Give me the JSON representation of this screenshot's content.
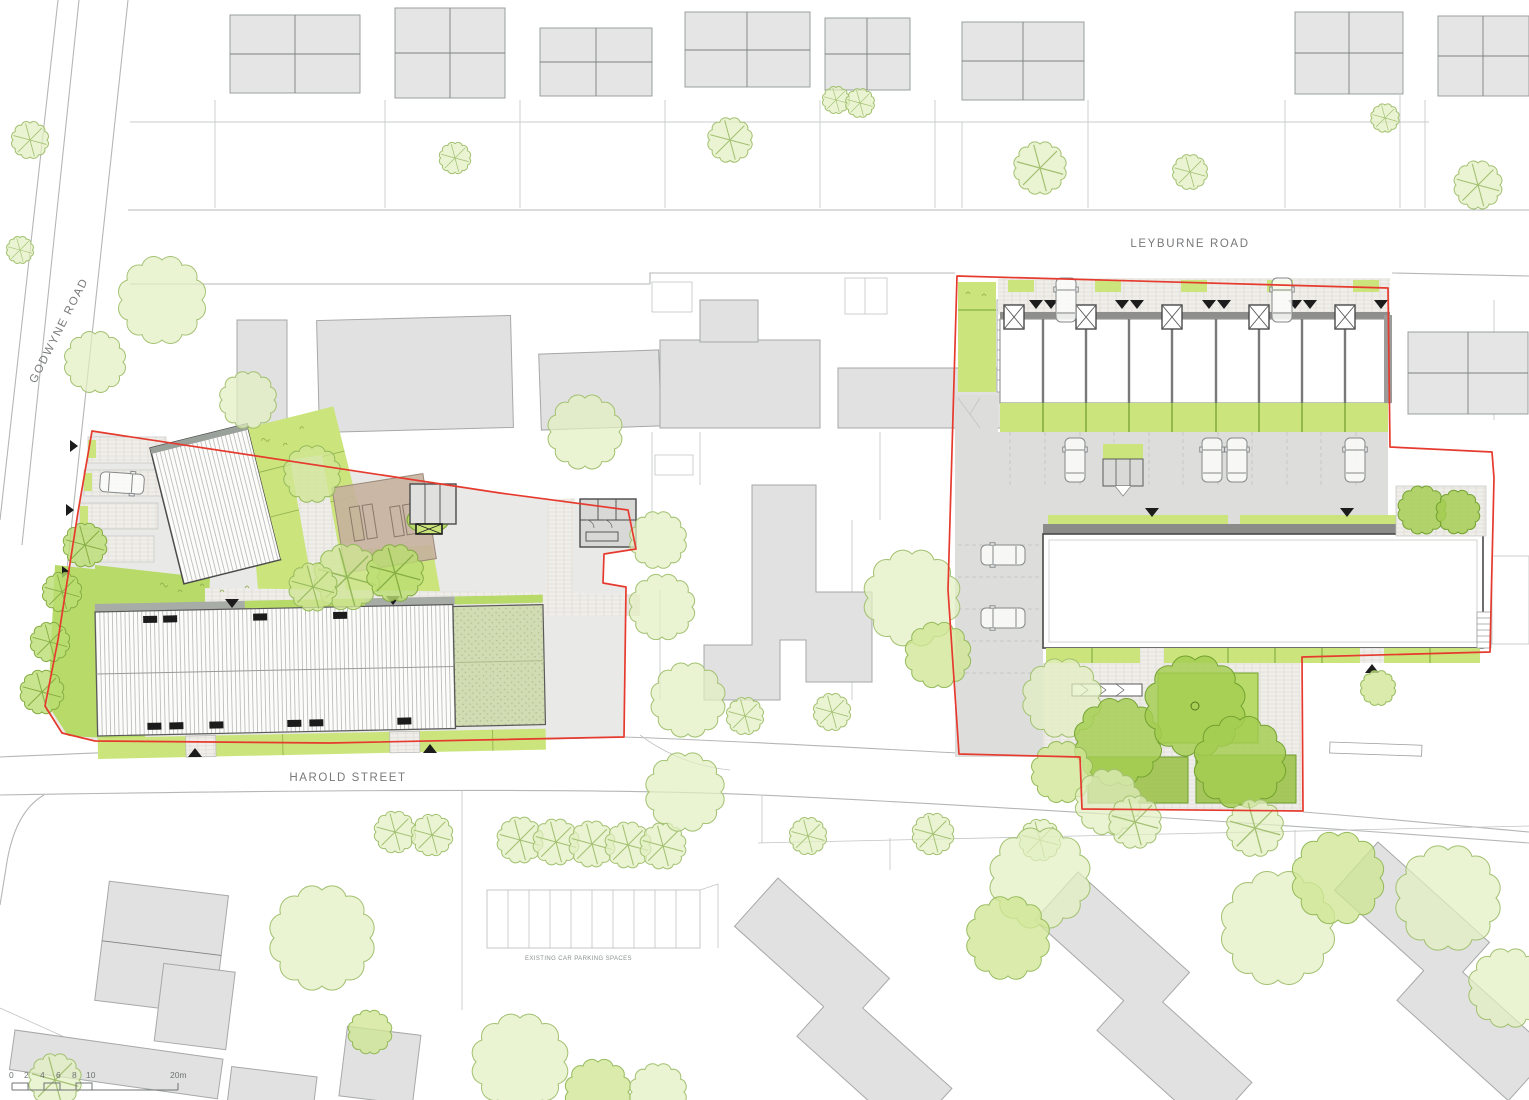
{
  "drawing": {
    "type": "architectural-site-plan",
    "labels": {
      "road_top": "LEYBURNE ROAD",
      "road_left": "GODWYNE ROAD",
      "road_bottom": "HAROLD STREET",
      "parking_note": "EXISTING CAR PARKING SPACES"
    },
    "scale_bar": {
      "ticks": [
        "0",
        "2",
        "4",
        "6",
        "8",
        "10"
      ],
      "end_label": "20m"
    },
    "colors": {
      "site_boundary_red": "#e63a2e",
      "lawn_green": "#cbe57c",
      "lawn_green_dark": "#b7da68",
      "tree_light": "#e2efc0",
      "tree_medium": "#cfe693",
      "tree_dark": "#a3cd50",
      "context_building_grey": "#e4e5e4",
      "paving_grey": "#e9e9e7",
      "terrace_brown": "#c7b19d",
      "sedum_roof": "#d2dcb4"
    }
  }
}
